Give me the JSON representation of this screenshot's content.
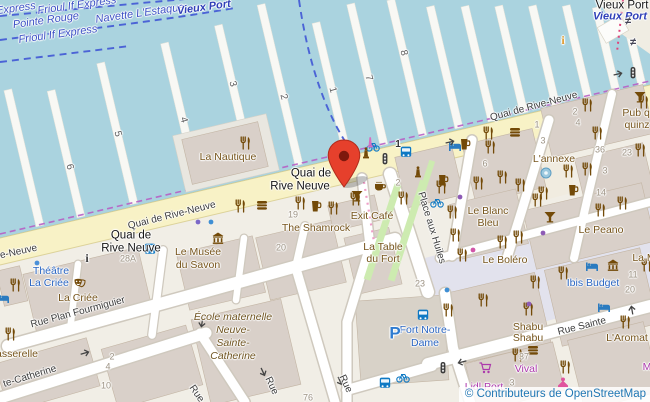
{
  "attribution": {
    "text": "© Contributeurs de OpenStreetMap"
  },
  "colors": {
    "water": "#aad3df",
    "land": "#f1eee6",
    "building": "#d9d0c9",
    "main_road": "#f8f2c6",
    "plaza": "#e2e2ed",
    "green": "#cdebb0",
    "pier": "#f8f8f4",
    "poi_brown": "#77551c",
    "poi_blue": "#2b66c2",
    "poi_magenta": "#ac39ac",
    "ferry_route_blue": "#4b63d6",
    "shore_purple": "#b65fc4",
    "marker_red": "#e6402c"
  },
  "labels": [
    {
      "t": "Express",
      "x": 16,
      "y": 9,
      "r": -8,
      "c": "wr"
    },
    {
      "t": "Frioul If Express",
      "x": 77,
      "y": 6,
      "r": -8,
      "c": "wr"
    },
    {
      "t": "Pointe Rouge",
      "x": 46,
      "y": 21,
      "r": -8,
      "c": "wr"
    },
    {
      "t": "Navette L'Estaque",
      "x": 140,
      "y": 14,
      "r": -8,
      "c": "wr"
    },
    {
      "t": "Vieux Port",
      "x": 204,
      "y": 8,
      "r": -8,
      "c": "wrb"
    },
    {
      "t": "Frioul If Express",
      "x": 58,
      "y": 35,
      "r": -8,
      "c": "wr"
    },
    {
      "t": "Vieux Port",
      "x": 622,
      "y": 6,
      "r": 0,
      "c": "pl"
    },
    {
      "t": "Vieux Port",
      "x": 620,
      "y": 17,
      "r": 0,
      "c": "wrb"
    },
    {
      "t": "Quai de",
      "x": 311,
      "y": 174,
      "r": 0,
      "c": "pl"
    },
    {
      "t": "Rive Neuve",
      "x": 300,
      "y": 187,
      "r": 0,
      "c": "pl"
    },
    {
      "t": "Quai de",
      "x": 131,
      "y": 236,
      "r": 0,
      "c": "pl"
    },
    {
      "t": "Rive Neuve",
      "x": 131,
      "y": 249,
      "r": 0,
      "c": "pl"
    },
    {
      "t": "Quai de Rive-Neuve",
      "x": 172,
      "y": 216,
      "r": -14,
      "c": "st"
    },
    {
      "t": "Quai de Rive-Neuve",
      "x": 534,
      "y": 107,
      "r": -15,
      "c": "st"
    },
    {
      "t": "ue-Neuve",
      "x": 16,
      "y": 253,
      "r": -12,
      "c": "st"
    },
    {
      "t": "Place aux Huiles",
      "x": 431,
      "y": 228,
      "r": 73,
      "c": "st"
    },
    {
      "t": "Rue Plan Fourmiguier",
      "x": 78,
      "y": 313,
      "r": -15,
      "c": "st"
    },
    {
      "t": "te-Catherine",
      "x": 30,
      "y": 377,
      "r": -17,
      "c": "st"
    },
    {
      "t": "Rue Sainte",
      "x": 582,
      "y": 327,
      "r": -14,
      "c": "st"
    },
    {
      "t": "Rue",
      "x": 196,
      "y": 394,
      "r": 55,
      "c": "st"
    },
    {
      "t": "Rue",
      "x": 271,
      "y": 386,
      "r": 65,
      "c": "st"
    },
    {
      "t": "Rue",
      "x": 345,
      "y": 384,
      "r": 65,
      "c": "st"
    },
    {
      "t": "La Nautique",
      "x": 228,
      "y": 157,
      "r": 0,
      "c": "poi"
    },
    {
      "t": "The Shamrock",
      "x": 316,
      "y": 228,
      "r": 0,
      "c": "poi"
    },
    {
      "t": "Exit Café",
      "x": 372,
      "y": 216,
      "r": 0,
      "c": "poi"
    },
    {
      "t": "La Table",
      "x": 383,
      "y": 247,
      "r": 0,
      "c": "poi"
    },
    {
      "t": "du Fort",
      "x": 383,
      "y": 259,
      "r": 0,
      "c": "poi"
    },
    {
      "t": "Le Blanc",
      "x": 488,
      "y": 211,
      "r": 0,
      "c": "poi"
    },
    {
      "t": "Bleu",
      "x": 488,
      "y": 223,
      "r": 0,
      "c": "poi"
    },
    {
      "t": "L'annexe",
      "x": 554,
      "y": 159,
      "r": 0,
      "c": "poi"
    },
    {
      "t": "Le Peano",
      "x": 601,
      "y": 230,
      "r": 0,
      "c": "poi"
    },
    {
      "t": "Le Boléro",
      "x": 505,
      "y": 260,
      "r": 0,
      "c": "poi"
    },
    {
      "t": "Shabu",
      "x": 528,
      "y": 327,
      "r": 0,
      "c": "poi"
    },
    {
      "t": "Shabu",
      "x": 528,
      "y": 338,
      "r": 0,
      "c": "poi"
    },
    {
      "t": "L'Aromat",
      "x": 627,
      "y": 338,
      "r": 0,
      "c": "poi"
    },
    {
      "t": "La Criée",
      "x": 78,
      "y": 298,
      "r": 0,
      "c": "poi"
    },
    {
      "t": "asserelle",
      "x": 17,
      "y": 354,
      "r": 0,
      "c": "poi"
    },
    {
      "t": "Le Musée",
      "x": 198,
      "y": 252,
      "r": 0,
      "c": "poi"
    },
    {
      "t": "du Savon",
      "x": 198,
      "y": 265,
      "r": 0,
      "c": "poi"
    },
    {
      "t": "Pub qu",
      "x": 639,
      "y": 113,
      "r": 0,
      "c": "poi"
    },
    {
      "t": "quinz",
      "x": 637,
      "y": 125,
      "r": 0,
      "c": "poi"
    },
    {
      "t": "La M",
      "x": 644,
      "y": 258,
      "r": 0,
      "c": "poi"
    },
    {
      "t": "École maternelle",
      "x": 233,
      "y": 317,
      "r": 0,
      "c": "poii"
    },
    {
      "t": "Neuve-",
      "x": 233,
      "y": 330,
      "r": 0,
      "c": "poii"
    },
    {
      "t": "Sainte-",
      "x": 233,
      "y": 343,
      "r": 0,
      "c": "poii"
    },
    {
      "t": "Catherine",
      "x": 233,
      "y": 356,
      "r": 0,
      "c": "poii"
    },
    {
      "t": "Théâtre",
      "x": 51,
      "y": 271,
      "r": 0,
      "c": "pb"
    },
    {
      "t": "La Criée",
      "x": 49,
      "y": 283,
      "r": 0,
      "c": "pb"
    },
    {
      "t": "Fort Notre-",
      "x": 425,
      "y": 330,
      "r": 0,
      "c": "pb"
    },
    {
      "t": "Dame",
      "x": 425,
      "y": 343,
      "r": 0,
      "c": "pb"
    },
    {
      "t": "Ibis Budget",
      "x": 593,
      "y": 283,
      "r": 0,
      "c": "pb"
    },
    {
      "t": "Vival",
      "x": 526,
      "y": 369,
      "r": 0,
      "c": "pm"
    },
    {
      "t": "Lidl Port",
      "x": 484,
      "y": 387,
      "r": 0,
      "c": "pm"
    },
    {
      "t": "M",
      "x": 647,
      "y": 367,
      "r": 0,
      "c": "pm"
    },
    {
      "t": "19",
      "x": 293,
      "y": 215,
      "r": 0,
      "c": "num"
    },
    {
      "t": "20",
      "x": 281,
      "y": 248,
      "r": 0,
      "c": "num"
    },
    {
      "t": "28A",
      "x": 128,
      "y": 259,
      "r": 0,
      "c": "num"
    },
    {
      "t": "2",
      "x": 398,
      "y": 183,
      "r": 0,
      "c": "num"
    },
    {
      "t": "36",
      "x": 600,
      "y": 150,
      "r": 0,
      "c": "num"
    },
    {
      "t": "23",
      "x": 627,
      "y": 153,
      "r": 0,
      "c": "num"
    },
    {
      "t": "3",
      "x": 605,
      "y": 171,
      "r": 0,
      "c": "num"
    },
    {
      "t": "14",
      "x": 601,
      "y": 193,
      "r": 0,
      "c": "num"
    },
    {
      "t": "6",
      "x": 485,
      "y": 164,
      "r": 0,
      "c": "num"
    },
    {
      "t": "2",
      "x": 575,
      "y": 112,
      "r": 0,
      "c": "num"
    },
    {
      "t": "4",
      "x": 578,
      "y": 123,
      "r": 0,
      "c": "num"
    },
    {
      "t": "1",
      "x": 537,
      "y": 125,
      "r": 0,
      "c": "num"
    },
    {
      "t": "3",
      "x": 543,
      "y": 141,
      "r": 0,
      "c": "num"
    },
    {
      "t": "11",
      "x": 633,
      "y": 275,
      "r": 0,
      "c": "num"
    },
    {
      "t": "20",
      "x": 630,
      "y": 290,
      "r": 0,
      "c": "num"
    },
    {
      "t": "37",
      "x": 524,
      "y": 357,
      "r": 0,
      "c": "num"
    },
    {
      "t": "3",
      "x": 512,
      "y": 383,
      "r": 0,
      "c": "num"
    },
    {
      "t": "2",
      "x": 112,
      "y": 357,
      "r": 0,
      "c": "num"
    },
    {
      "t": "4",
      "x": 108,
      "y": 367,
      "r": 0,
      "c": "num"
    },
    {
      "t": "10",
      "x": 106,
      "y": 386,
      "r": 0,
      "c": "num"
    },
    {
      "t": "76",
      "x": 308,
      "y": 398,
      "r": 0,
      "c": "num"
    },
    {
      "t": "23",
      "x": 420,
      "y": 284,
      "r": 0,
      "c": "num"
    },
    {
      "t": "1",
      "x": 398,
      "y": 145,
      "r": 0,
      "c": "numd"
    },
    {
      "t": "6",
      "x": 69,
      "y": 167,
      "r": 75,
      "c": "pnum"
    },
    {
      "t": "5",
      "x": 117,
      "y": 134,
      "r": 75,
      "c": "pnum"
    },
    {
      "t": "4",
      "x": 183,
      "y": 120,
      "r": 75,
      "c": "pnum"
    },
    {
      "t": "3",
      "x": 232,
      "y": 84,
      "r": 75,
      "c": "pnum"
    },
    {
      "t": "2",
      "x": 283,
      "y": 97,
      "r": 75,
      "c": "pnum"
    },
    {
      "t": "1",
      "x": 332,
      "y": 90,
      "r": 75,
      "c": "pnum"
    },
    {
      "t": "7",
      "x": 368,
      "y": 78,
      "r": 75,
      "c": "pnum"
    },
    {
      "t": "8",
      "x": 403,
      "y": 53,
      "r": 75,
      "c": "pnum"
    },
    {
      "t": "P",
      "x": 395,
      "y": 333,
      "r": 0,
      "c": "pk"
    },
    {
      "t": "i",
      "x": 87,
      "y": 258,
      "r": 0,
      "c": "info"
    },
    {
      "t": "i",
      "x": 563,
      "y": 40,
      "r": 0,
      "c": "infoo"
    },
    {
      "t": "≠",
      "x": 628,
      "y": 22,
      "r": 0,
      "c": "feq"
    },
    {
      "t": "≠",
      "x": 633,
      "y": 43,
      "r": 0,
      "c": "feq"
    }
  ],
  "icons": [
    {
      "k": "restaurant",
      "x": 245,
      "y": 143
    },
    {
      "k": "restaurant",
      "x": 240,
      "y": 206
    },
    {
      "k": "restaurant",
      "x": 300,
      "y": 203
    },
    {
      "k": "restaurant",
      "x": 333,
      "y": 208
    },
    {
      "k": "restaurant",
      "x": 355,
      "y": 199
    },
    {
      "k": "restaurant",
      "x": 403,
      "y": 198
    },
    {
      "k": "restaurant",
      "x": 441,
      "y": 187
    },
    {
      "k": "restaurant",
      "x": 490,
      "y": 147
    },
    {
      "k": "restaurant",
      "x": 502,
      "y": 177
    },
    {
      "k": "restaurant",
      "x": 478,
      "y": 183
    },
    {
      "k": "restaurant",
      "x": 520,
      "y": 185
    },
    {
      "k": "restaurant",
      "x": 543,
      "y": 193
    },
    {
      "k": "restaurant",
      "x": 568,
      "y": 171
    },
    {
      "k": "restaurant",
      "x": 587,
      "y": 169
    },
    {
      "k": "restaurant",
      "x": 600,
      "y": 210
    },
    {
      "k": "restaurant",
      "x": 622,
      "y": 203
    },
    {
      "k": "restaurant",
      "x": 537,
      "y": 200
    },
    {
      "k": "restaurant",
      "x": 502,
      "y": 242
    },
    {
      "k": "restaurant",
      "x": 518,
      "y": 237
    },
    {
      "k": "restaurant",
      "x": 462,
      "y": 255
    },
    {
      "k": "restaurant",
      "x": 455,
      "y": 235
    },
    {
      "k": "restaurant",
      "x": 452,
      "y": 212
    },
    {
      "k": "restaurant",
      "x": 535,
      "y": 282
    },
    {
      "k": "restaurant",
      "x": 483,
      "y": 300
    },
    {
      "k": "restaurant",
      "x": 528,
      "y": 309
    },
    {
      "k": "restaurant",
      "x": 448,
      "y": 310
    },
    {
      "k": "restaurant",
      "x": 563,
      "y": 273
    },
    {
      "k": "restaurant",
      "x": 517,
      "y": 355
    },
    {
      "k": "restaurant",
      "x": 565,
      "y": 367
    },
    {
      "k": "restaurant",
      "x": 625,
      "y": 322
    },
    {
      "k": "restaurant",
      "x": 646,
      "y": 265
    },
    {
      "k": "restaurant",
      "x": 587,
      "y": 105
    },
    {
      "k": "restaurant",
      "x": 597,
      "y": 133
    },
    {
      "k": "restaurant",
      "x": 488,
      "y": 133
    },
    {
      "k": "restaurant",
      "x": 640,
      "y": 150
    },
    {
      "k": "restaurant",
      "x": 643,
      "y": 102
    },
    {
      "k": "restaurant",
      "x": 15,
      "y": 285
    },
    {
      "k": "restaurant",
      "x": 10,
      "y": 334
    },
    {
      "k": "beer",
      "x": 316,
      "y": 206
    },
    {
      "k": "beer",
      "x": 443,
      "y": 180
    },
    {
      "k": "beer",
      "x": 465,
      "y": 144
    },
    {
      "k": "beer",
      "x": 573,
      "y": 190
    },
    {
      "k": "cafe",
      "x": 380,
      "y": 186
    },
    {
      "k": "cocktail",
      "x": 357,
      "y": 196
    },
    {
      "k": "cocktail",
      "x": 550,
      "y": 217
    },
    {
      "k": "cocktail",
      "x": 640,
      "y": 97
    },
    {
      "k": "burger",
      "x": 262,
      "y": 205
    },
    {
      "k": "burger",
      "x": 515,
      "y": 132
    },
    {
      "k": "burger",
      "x": 533,
      "y": 350
    },
    {
      "k": "bed",
      "x": 3,
      "y": 298
    },
    {
      "k": "bed",
      "x": 455,
      "y": 146
    },
    {
      "k": "bed",
      "x": 592,
      "y": 266
    },
    {
      "k": "bed",
      "x": 604,
      "y": 307
    },
    {
      "k": "bus",
      "x": 150,
      "y": 249
    },
    {
      "k": "bus",
      "x": 406,
      "y": 152
    },
    {
      "k": "bus",
      "x": 423,
      "y": 315
    },
    {
      "k": "bus",
      "x": 385,
      "y": 383
    },
    {
      "k": "bike",
      "x": 373,
      "y": 146
    },
    {
      "k": "bike",
      "x": 437,
      "y": 202
    },
    {
      "k": "bike",
      "x": 403,
      "y": 377
    },
    {
      "k": "tlight",
      "x": 385,
      "y": 159
    },
    {
      "k": "tlight",
      "x": 633,
      "y": 73
    },
    {
      "k": "tlight",
      "x": 443,
      "y": 368
    },
    {
      "k": "classical",
      "x": 218,
      "y": 238
    },
    {
      "k": "classical",
      "x": 613,
      "y": 265
    },
    {
      "k": "masks",
      "x": 80,
      "y": 284
    },
    {
      "k": "statue",
      "x": 366,
      "y": 153
    },
    {
      "k": "statue",
      "x": 418,
      "y": 172
    },
    {
      "k": "memorial",
      "x": 370,
      "y": 142
    },
    {
      "k": "fountain",
      "x": 546,
      "y": 173
    },
    {
      "k": "cart",
      "x": 485,
      "y": 368
    },
    {
      "k": "clothes",
      "x": 563,
      "y": 383
    },
    {
      "k": "arrow",
      "x": 85,
      "y": 353,
      "r": -16
    },
    {
      "k": "arrow",
      "x": 450,
      "y": 142,
      "r": -13
    },
    {
      "k": "arrow",
      "x": 618,
      "y": 74,
      "r": -13
    },
    {
      "k": "arrow",
      "x": 462,
      "y": 362,
      "r": 166
    },
    {
      "k": "arrow",
      "x": 202,
      "y": 323,
      "r": 100
    },
    {
      "k": "arrow",
      "x": 263,
      "y": 372,
      "r": 65
    },
    {
      "k": "arrow",
      "x": 340,
      "y": 381,
      "r": 65
    },
    {
      "k": "arrow",
      "x": 632,
      "y": 310,
      "r": -100
    },
    {
      "k": "dot",
      "x": 198,
      "y": 222,
      "c": "#7b68c8"
    },
    {
      "k": "dot",
      "x": 211,
      "y": 222,
      "c": "#3f8fd4"
    },
    {
      "k": "dot",
      "x": 460,
      "y": 197,
      "c": "#8e5bb5"
    },
    {
      "k": "dot",
      "x": 473,
      "y": 250,
      "c": "#d156a8"
    },
    {
      "k": "dot",
      "x": 529,
      "y": 304,
      "c": "#8e5bb5"
    },
    {
      "k": "dot",
      "x": 447,
      "y": 290,
      "c": "#3f8fd4"
    },
    {
      "k": "dot",
      "x": 543,
      "y": 233,
      "c": "#8e5bb5"
    },
    {
      "k": "dot",
      "x": 37,
      "y": 263,
      "c": "#4a90d9"
    }
  ],
  "marker": {
    "x": 344,
    "y": 187
  }
}
